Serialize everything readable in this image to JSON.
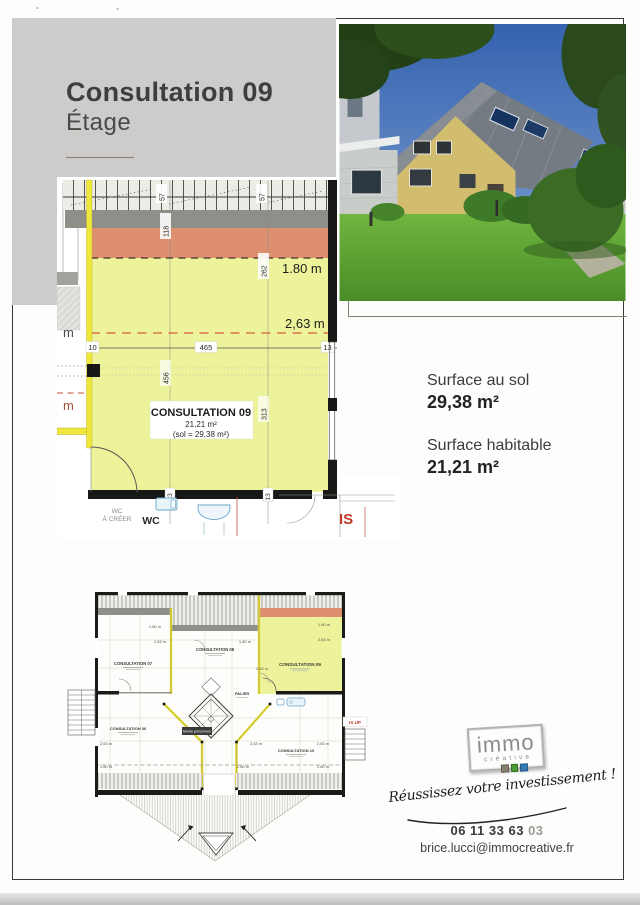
{
  "header": {
    "title": "Consultation 09",
    "subtitle": "Étage"
  },
  "surfaces": {
    "sol_label": "Surface au sol",
    "sol_value": "29,38 m²",
    "hab_label": "Surface habitable",
    "hab_value": "21,21 m²"
  },
  "plan_main": {
    "room_name": "CONSULTATION 09",
    "room_area": "21,21 m²",
    "room_sol": "(sol = 29,38 m²)",
    "dim_180": "1.80 m",
    "dim_263": "2,63 m",
    "rafter_57_left": "57",
    "rafter_57_right": "57",
    "dim_118": "118",
    "dim_262": "262",
    "dim_456": "456",
    "dim_313": "313",
    "dim_10": "10",
    "dim_465": "465",
    "dim_13_right": "13",
    "dim_13_wall_left": "13",
    "dim_13_wall_mid": "13",
    "m_upper": "m",
    "m_lower": "m",
    "wc_small_1": "WC",
    "wc_small_2": "À CRÉER",
    "wc_bold": "WC",
    "is_label": "IS"
  },
  "plan_overview": {
    "room07": "CONSULTATION 07",
    "room08": "CONSULTATION 08",
    "room09": "CONSULTATION 09",
    "room06": "CONSULTATION 06",
    "room10": "CONSULTATION 10",
    "palier": "PALIER",
    "monte": "Monte personnes",
    "is_up": "IS UP",
    "dims": {
      "d180_tl": "1.80 m",
      "d263_tl": "2,63 m",
      "d180_c": "1,80 m",
      "d253": "2,53 m",
      "d180_r": "1.80 m",
      "d263_r": "2,63 m",
      "d263_bl": "2,63 m",
      "d263_bm": "2,63 m",
      "d263_br": "2,63 m",
      "d180_bl": "1.80 m",
      "d180_bm": "1.80 m",
      "d180_br": "1.80 m"
    }
  },
  "brand": {
    "logo_top": "immo",
    "logo_sub": "créative",
    "tagline": "Réussissez votre investissement !",
    "phone": "06 11 33 63",
    "phone_suffix": "03",
    "email": "brice.lucci@immocreative.fr"
  },
  "colors": {
    "highlight_yellow": "#edf39b",
    "band_salmon": "#de8f70",
    "band_gray": "#8f8f8a",
    "panel_gray": "#cdccca",
    "wall_black": "#1b1b19",
    "red_accent": "#c0392b"
  }
}
